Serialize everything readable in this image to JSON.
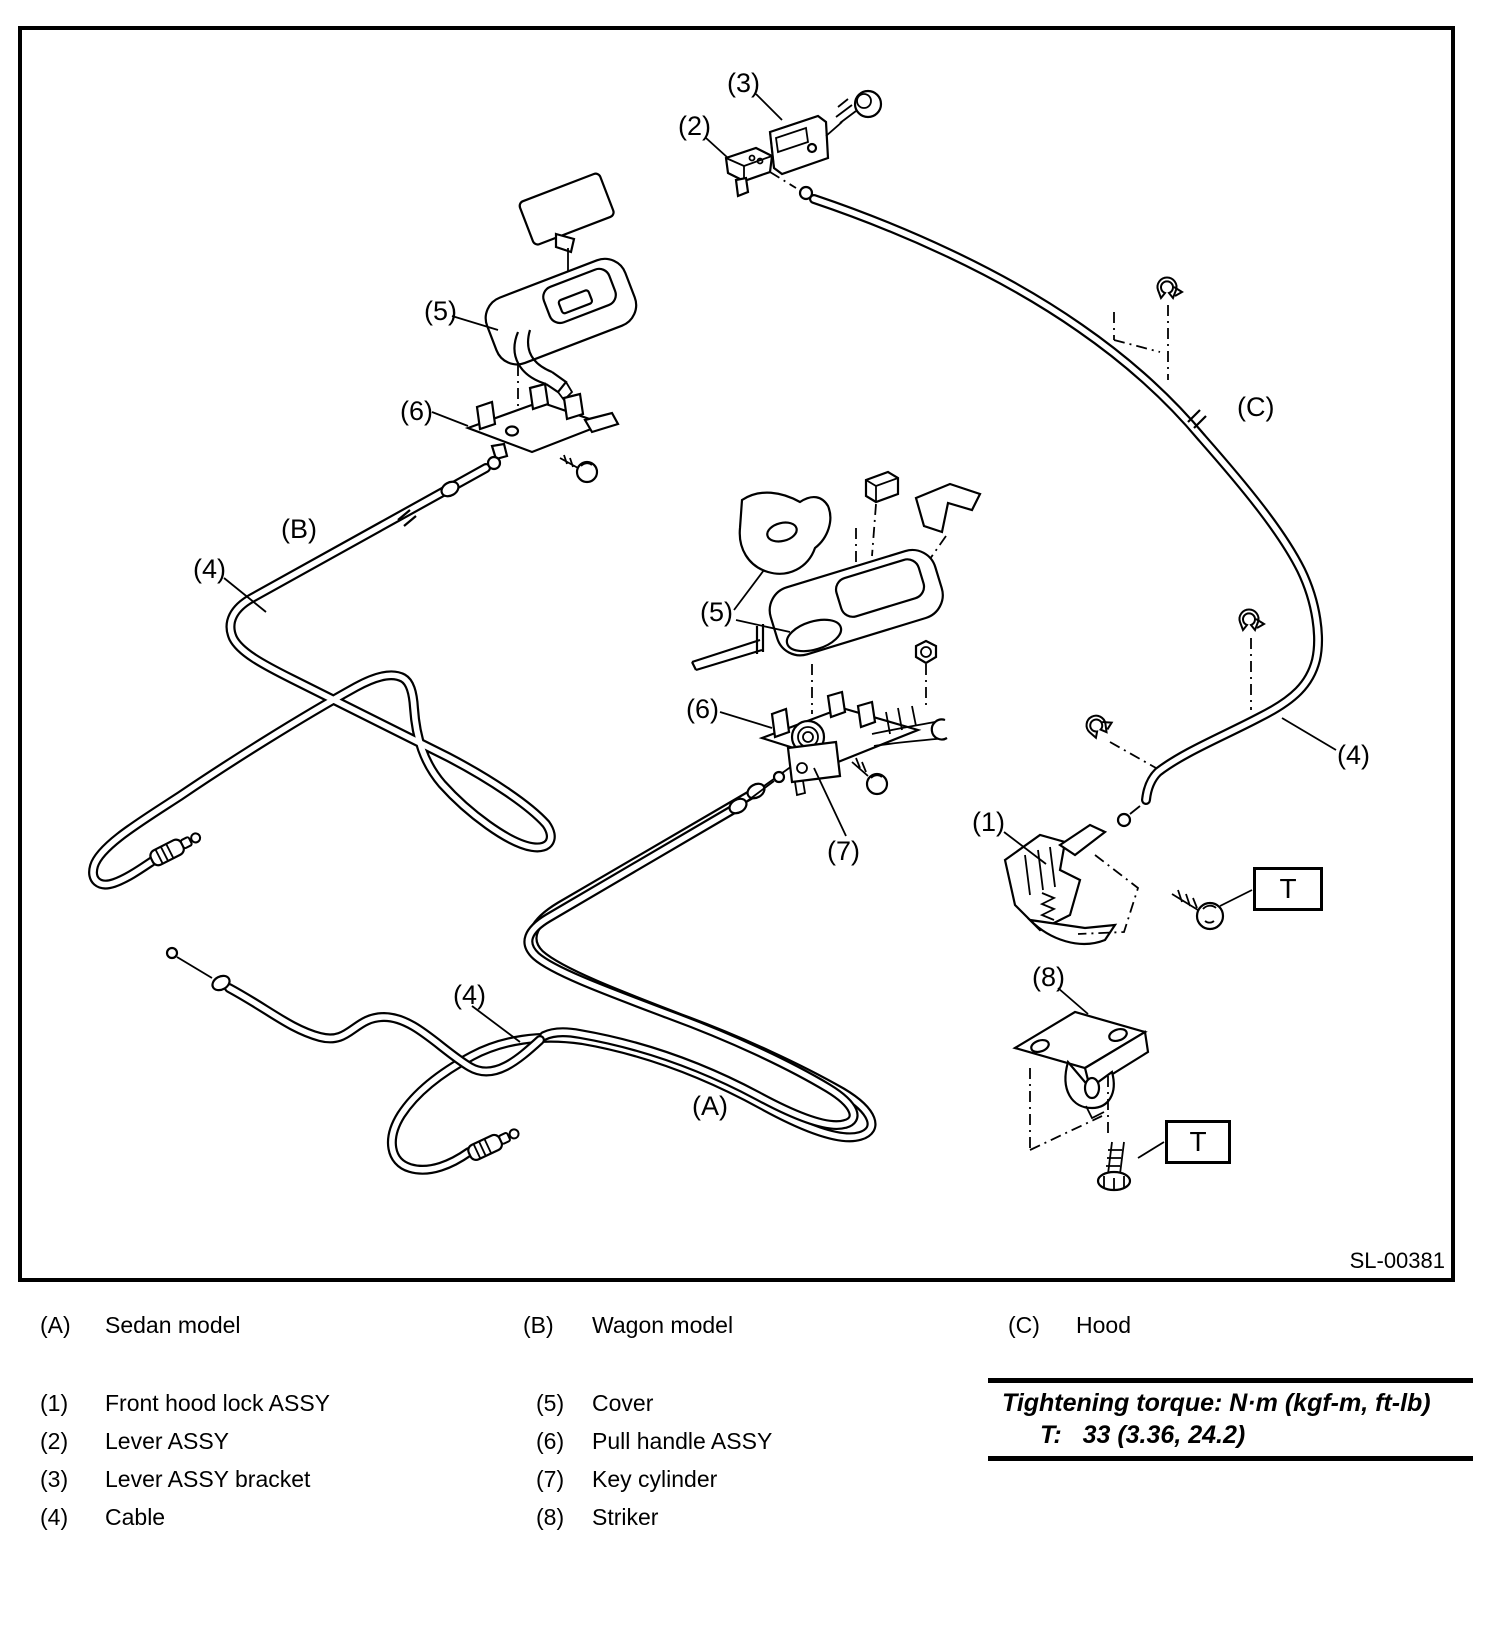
{
  "diagram": {
    "figure_code": "SL-00381",
    "callouts": {
      "n1": "(1)",
      "n2": "(2)",
      "n3": "(3)",
      "n4": "(4)",
      "n5": "(5)",
      "n6": "(6)",
      "n7": "(7)",
      "n8": "(8)",
      "a": "(A)",
      "b": "(B)",
      "c": "(C)",
      "torque_marker": "T"
    }
  },
  "legend": {
    "models": [
      {
        "key": "(A)",
        "label": "Sedan model"
      },
      {
        "key": "(B)",
        "label": "Wagon model"
      },
      {
        "key": "(C)",
        "label": "Hood"
      }
    ],
    "parts": [
      {
        "key": "(1)",
        "label": "Front hood lock ASSY"
      },
      {
        "key": "(2)",
        "label": "Lever ASSY"
      },
      {
        "key": "(3)",
        "label": "Lever ASSY bracket"
      },
      {
        "key": "(4)",
        "label": "Cable"
      },
      {
        "key": "(5)",
        "label": "Cover"
      },
      {
        "key": "(6)",
        "label": "Pull handle ASSY"
      },
      {
        "key": "(7)",
        "label": "Key cylinder"
      },
      {
        "key": "(8)",
        "label": "Striker"
      }
    ],
    "torque_note": {
      "title": "Tightening torque: N·m (kgf-m, ft-lb)",
      "value": "T:   33 (3.36, 24.2)"
    }
  }
}
